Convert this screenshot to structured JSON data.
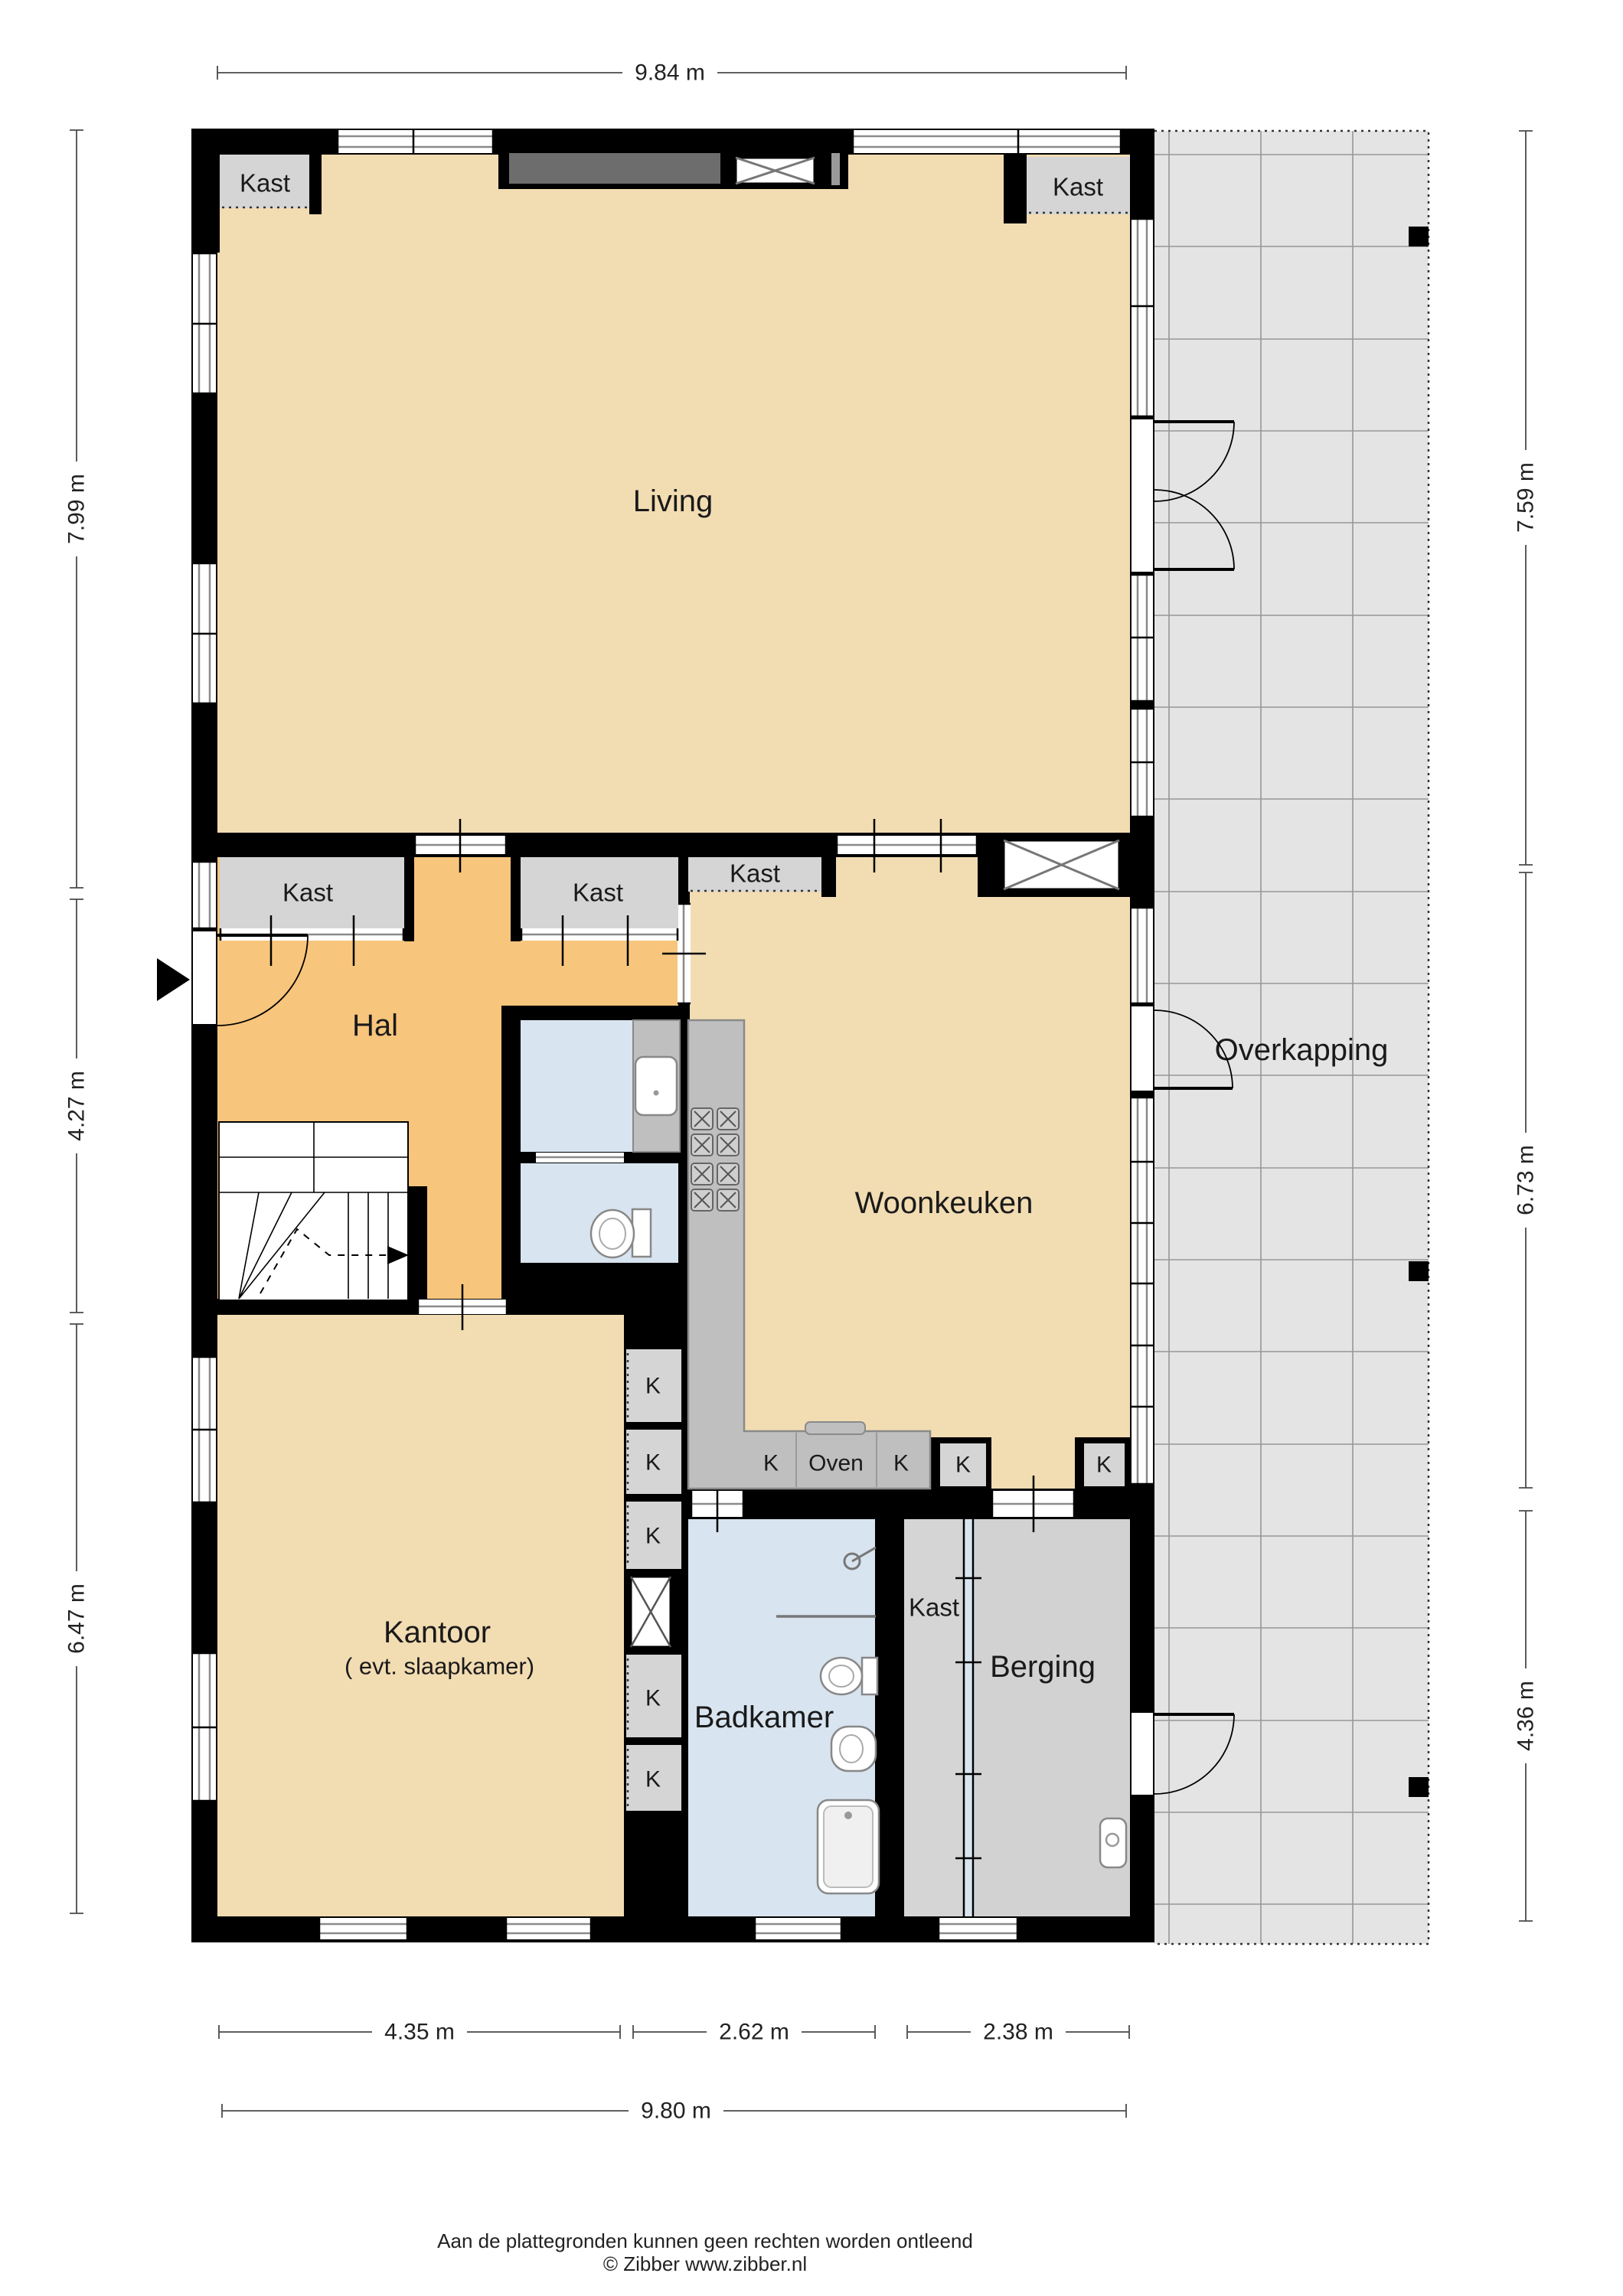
{
  "labels": {
    "living": "Living",
    "hal": "Hal",
    "woonkeuken": "Woonkeuken",
    "kantoor": "Kantoor",
    "kantoor_sub": "( evt. slaapkamer)",
    "badkamer": "Badkamer",
    "berging": "Berging",
    "overkapping": "Overkapping",
    "kast": "Kast",
    "k": "K",
    "oven": "Oven"
  },
  "dimensions": {
    "top": "9.84 m",
    "left_upper": "7.99 m",
    "left_middle": "4.27 m",
    "left_lower": "6.47 m",
    "right_upper": "7.59 m",
    "right_middle": "6.73 m",
    "right_lower": "4.36 m",
    "bottom_kantoor": "4.35 m",
    "bottom_badkamer": "2.62 m",
    "bottom_berging": "2.38 m",
    "bottom_total": "9.80 m"
  },
  "footer": {
    "disclaimer": "Aan de plattegronden kunnen geen rechten worden ontleend",
    "credit": "© Zibber www.zibber.nl"
  },
  "colors": {
    "wall": "#000000",
    "floor_main": "#f2dcb2",
    "floor_hal": "#f8c57c",
    "floor_bath": "#d8e4ef",
    "floor_storage": "#d2d2d2",
    "closet": "#d5d5d5",
    "counter": "#bfbfbf",
    "canopy": "#e4e4e4",
    "cupboard_dark": "#6d6d6d"
  }
}
